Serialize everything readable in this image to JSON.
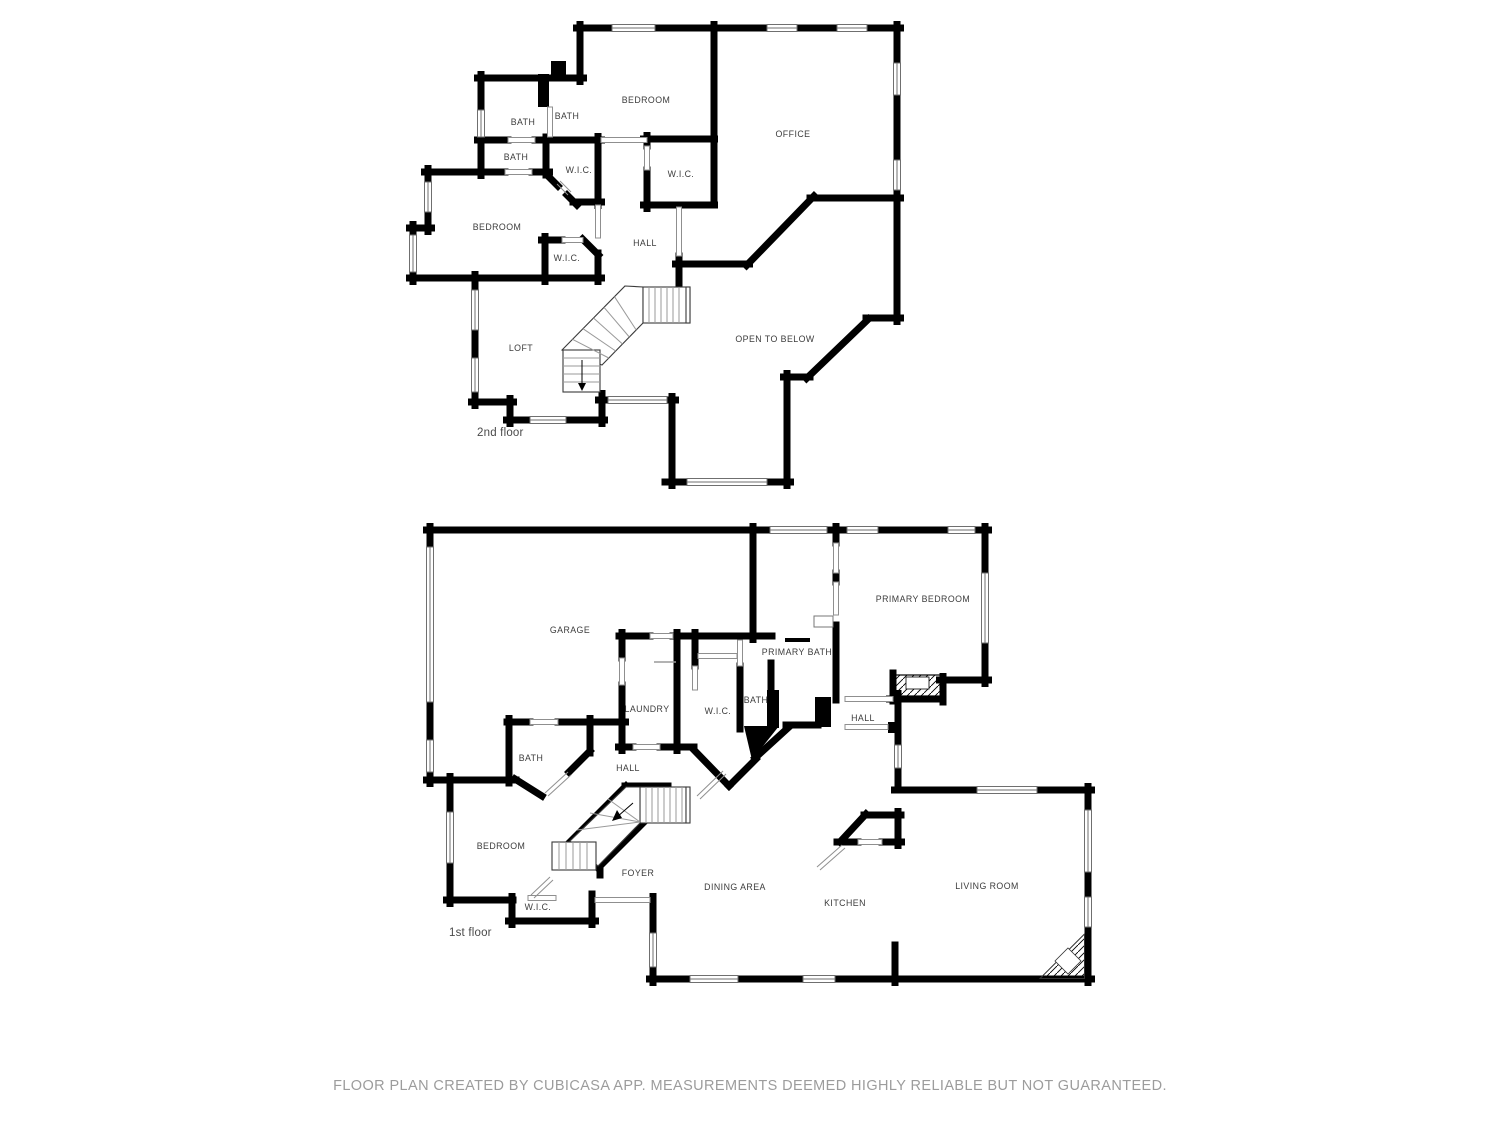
{
  "floor2": {
    "name": "2nd floor",
    "rooms": {
      "bath1": "BATH",
      "bath2": "BATH",
      "bath3": "BATH",
      "bedroom_top": "BEDROOM",
      "office": "OFFICE",
      "wic1": "W.I.C.",
      "wic2": "W.I.C.",
      "bedroom_mid": "BEDROOM",
      "hall": "HALL",
      "wic3": "W.I.C.",
      "loft": "LOFT",
      "open_to_below": "OPEN TO BELOW"
    }
  },
  "floor1": {
    "name": "1st floor",
    "rooms": {
      "garage": "GARAGE",
      "primary_bedroom": "PRIMARY BEDROOM",
      "primary_bath": "PRIMARY BATH",
      "laundry": "LAUNDRY",
      "wic_center": "W.I.C.",
      "bath_center": "BATH",
      "hall_right": "HALL",
      "bath_left": "BATH",
      "hall_left": "HALL",
      "bedroom": "BEDROOM",
      "wic_lower": "W.I.C.",
      "foyer": "FOYER",
      "dining": "DINING AREA",
      "kitchen": "KITCHEN",
      "living": "LIVING ROOM"
    }
  },
  "footer": {
    "disclaimer": "FLOOR PLAN CREATED BY CUBICASA APP. MEASUREMENTS DEEMED HIGHLY RELIABLE BUT NOT GUARANTEED."
  },
  "colors": {
    "wall": "#000000",
    "window_line": "#6f6f6f",
    "door_line": "#8f8f8f",
    "stair_line": "#3a3a3a",
    "label_text": "#3c3c3c",
    "footer_text": "#9c9c9c",
    "background": "#ffffff"
  }
}
